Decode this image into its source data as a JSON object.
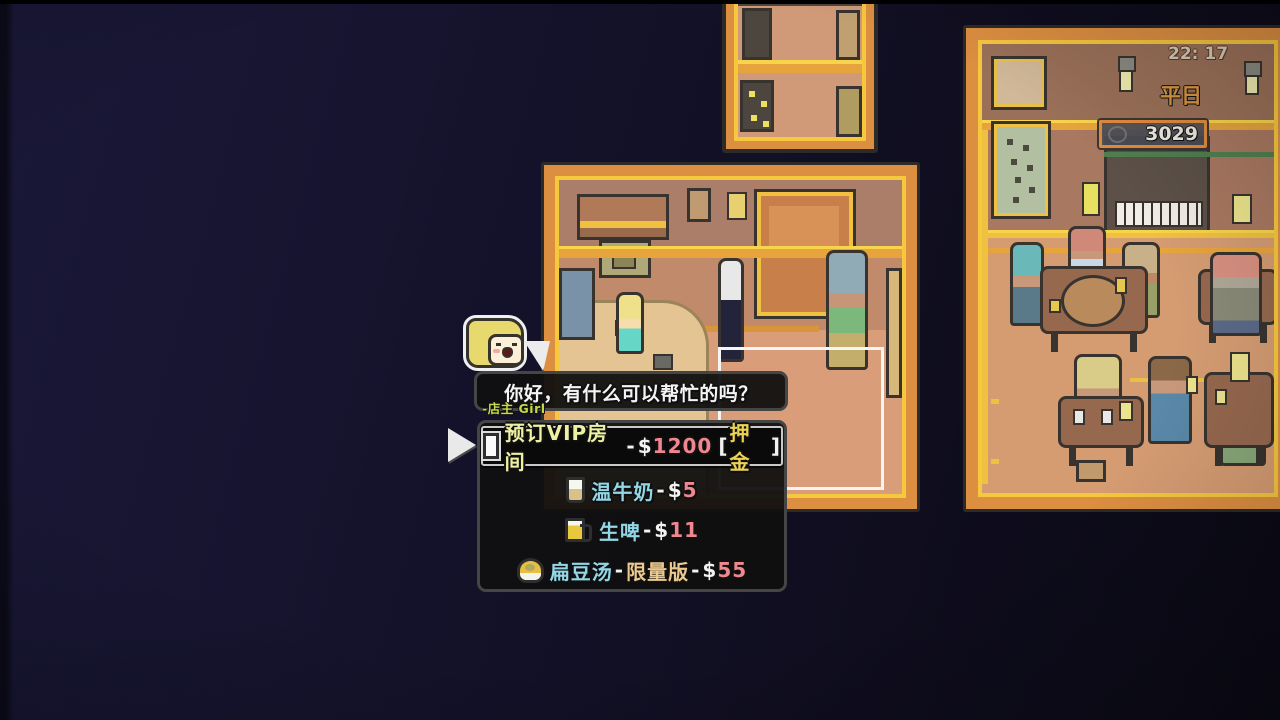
{
  "hud": {
    "time": "22: 17",
    "day": "平日",
    "money": "3029"
  },
  "dialog": {
    "text": "你好，有什么可以帮忙的吗？",
    "speaker": "-店主 Girl"
  },
  "menu": {
    "items": [
      {
        "icon": "door-icon",
        "name": "预订VIP房间",
        "dash": "-",
        "dollar": "$",
        "amount": "1200",
        "bracket_open": "[",
        "tag": "押金",
        "bracket_close": "]",
        "selected": true
      },
      {
        "icon": "milk-icon",
        "name": "温牛奶",
        "dash": "-",
        "dollar": "$",
        "amount": "5",
        "selected": false
      },
      {
        "icon": "beer-icon",
        "name": "生啤",
        "dash": "-",
        "dollar": "$",
        "amount": "11",
        "selected": false
      },
      {
        "icon": "soup-icon",
        "name": "扁豆汤",
        "dash": "-",
        "tag": "限量版",
        "dash2": "-",
        "dollar": "$",
        "amount": "55",
        "selected": false
      }
    ]
  },
  "palette": {
    "background_navy": "#15132c",
    "panel_border_orange": "#dd8f41",
    "panel_frame_yellow": "#f6c83e",
    "wall_brown": "#a87860",
    "floor_salmon": "#d99e79",
    "menu_item_blue": "#93d6e6",
    "price_pink": "#f0878f",
    "tag_yellow": "#ecd255",
    "tag_amber": "#ecc98d",
    "vip_name": "#eef0a2",
    "speaker_green": "#c6d94b",
    "day_orange": "#d9963f"
  }
}
